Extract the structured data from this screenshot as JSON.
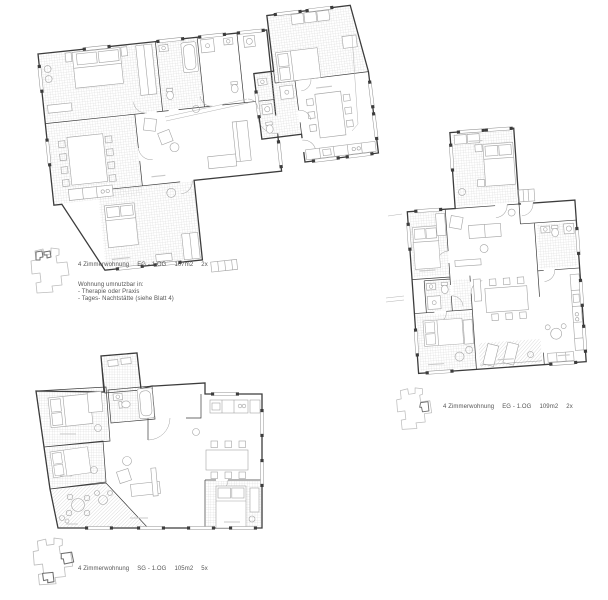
{
  "sheet": {
    "width": 608,
    "height": 600,
    "background": "#ffffff"
  },
  "colors": {
    "wall": "#3c3c3c",
    "wall_light": "#909090",
    "furniture": "#a3a3a3",
    "hatch": "#d2d2d2",
    "hatch_diagonal": "#c8c8c8",
    "context_line": "#b4b4b4",
    "keyplan_outline": "#bdbdbd",
    "keyplan_highlight": "#6e6e6e",
    "label_text": "#555555"
  },
  "labels": {
    "top": {
      "title": "4 Zimmerwohnung",
      "floors": "EG - 1.OG",
      "area": "107m2",
      "count": "2x",
      "notes": [
        "Wohnung umnutzbar in:",
        "- Therapie oder Praxis",
        "- Tages- Nachtstätte (siehe Blatt 4)"
      ]
    },
    "right": {
      "title": "4 Zimmerwohnung",
      "floors": "EG - 1.OG",
      "area": "109m2",
      "count": "2x"
    },
    "bottom": {
      "title": "4 Zimmerwohnung",
      "floors": "SG - 1.OG",
      "area": "105m2",
      "count": "5x"
    }
  }
}
